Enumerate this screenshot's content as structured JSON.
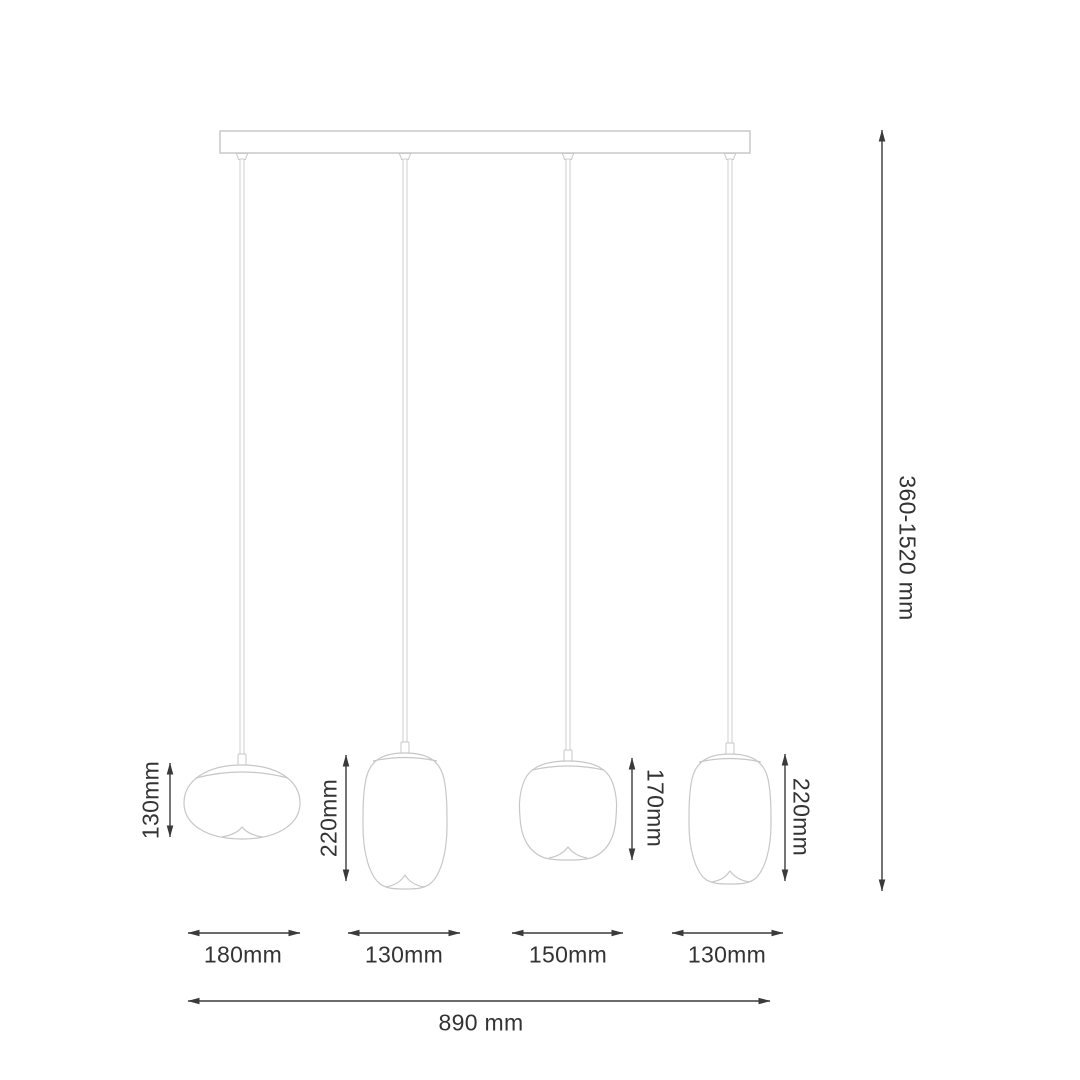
{
  "diagram": {
    "subject": "4-light linear pendant lamp dimension drawing",
    "colors": {
      "fixture_outline": "#c7c7c7",
      "dimension_line": "#3a3a3a",
      "label_text": "#333333",
      "background": "#ffffff"
    },
    "overall": {
      "height_label": "360-1520 mm",
      "width_label": "890 mm"
    },
    "pendants": [
      {
        "name": "pendant-1",
        "shape": "oblate",
        "height_label": "130mm",
        "width_label": "180mm"
      },
      {
        "name": "pendant-2",
        "shape": "capsule",
        "height_label": "220mm",
        "width_label": "130mm"
      },
      {
        "name": "pendant-3",
        "shape": "round",
        "height_label": "170mm",
        "width_label": "150mm"
      },
      {
        "name": "pendant-4",
        "shape": "capsule",
        "height_label": "220mm",
        "width_label": "130mm"
      }
    ]
  }
}
